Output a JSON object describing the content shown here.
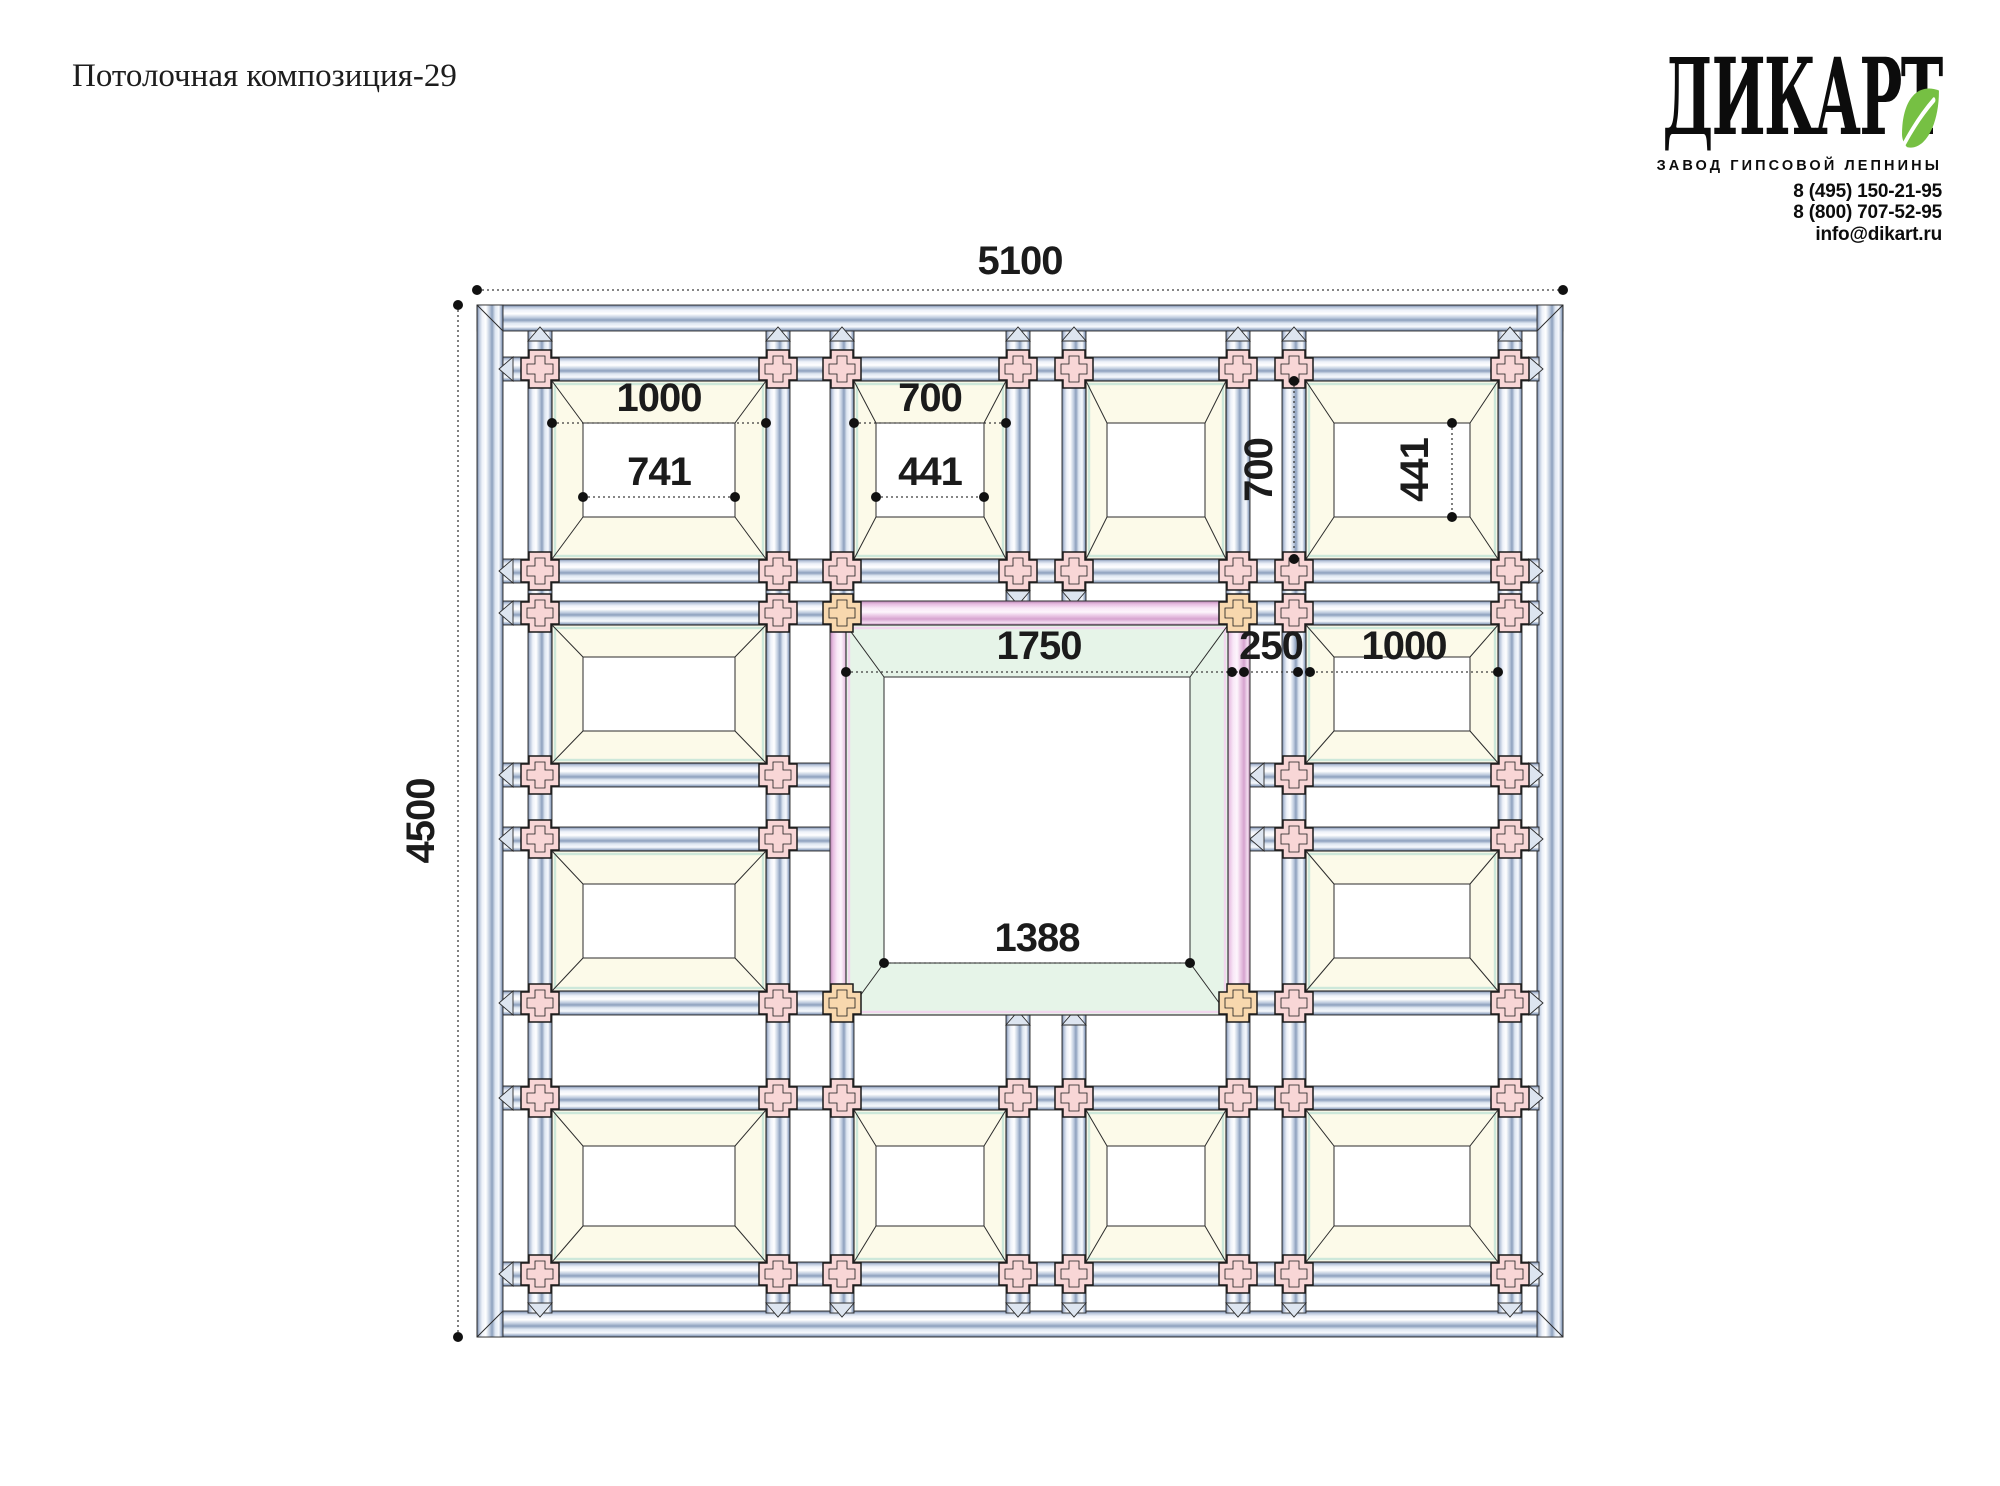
{
  "header": {
    "title": "Потолочная композиция-29"
  },
  "logo": {
    "brand": "ДИКАРТ",
    "tagline": "ЗАВОД ГИПСОВОЙ ЛЕПНИНЫ",
    "phone1": "8 (495) 150-21-95",
    "phone2": "8 (800) 707-52-95",
    "email": "info@dikart.ru",
    "leaf_color": "#76c043"
  },
  "drawing": {
    "labels": {
      "overall_width": "5100",
      "overall_height": "4500",
      "top_large_outer": "1000",
      "top_large_inner": "741",
      "top_small_outer": "700",
      "top_small_inner": "441",
      "right_small_outer": "700",
      "right_small_inner": "441",
      "center_outer": "1750",
      "band": "250",
      "mid_right_outer": "1000",
      "center_inner": "1388"
    },
    "colors": {
      "ink": "#2b2b2b",
      "dim_line": "#3c3c3c",
      "beam_blue_dark": "#5f7292",
      "beam_blue_light": "#eef2f9",
      "band_pink_dark": "#b47fae",
      "band_pink_light": "#f9e8f7",
      "cross_pink": "#f8d6d6",
      "cross_orange": "#f8d8ae",
      "coffer_cream": "#fcfae9",
      "coffer_accent_mint": "#cde8da",
      "center_green": "#e6f4e8",
      "center_accent_pink": "#f2d7ee",
      "triangle_fill": "#dde5f0"
    }
  }
}
